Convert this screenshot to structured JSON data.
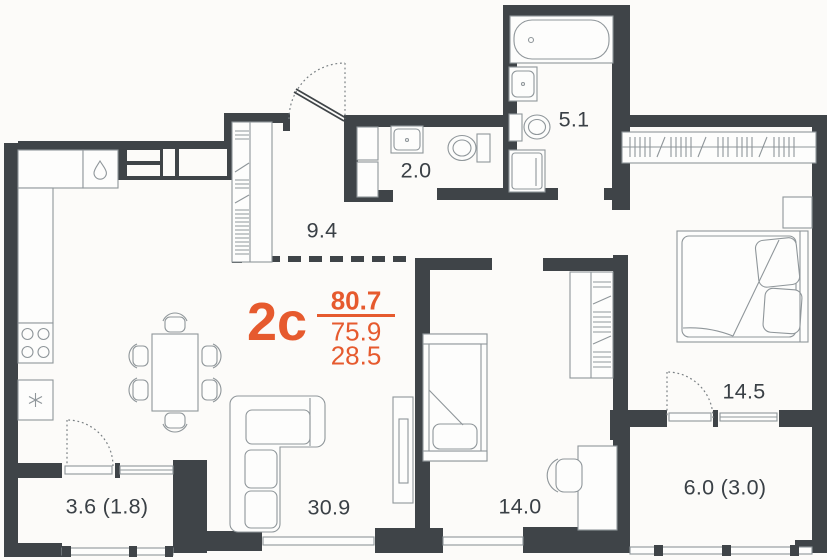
{
  "plan": {
    "unit_type": "2с",
    "areas": {
      "total": "80.7",
      "main": "75.9",
      "living": "28.5"
    },
    "rooms": {
      "hallway": "9.4",
      "wc": "2.0",
      "bathroom": "5.1",
      "bedroom": "14.5",
      "living_kitchen": "30.9",
      "child_room": "14.0",
      "balcony_right": "6.0 (3.0)",
      "balcony_left": "3.6 (1.8)"
    },
    "colors": {
      "accent": "#E65A2E",
      "wall": "#3F4448",
      "label": "#3A4046"
    }
  }
}
